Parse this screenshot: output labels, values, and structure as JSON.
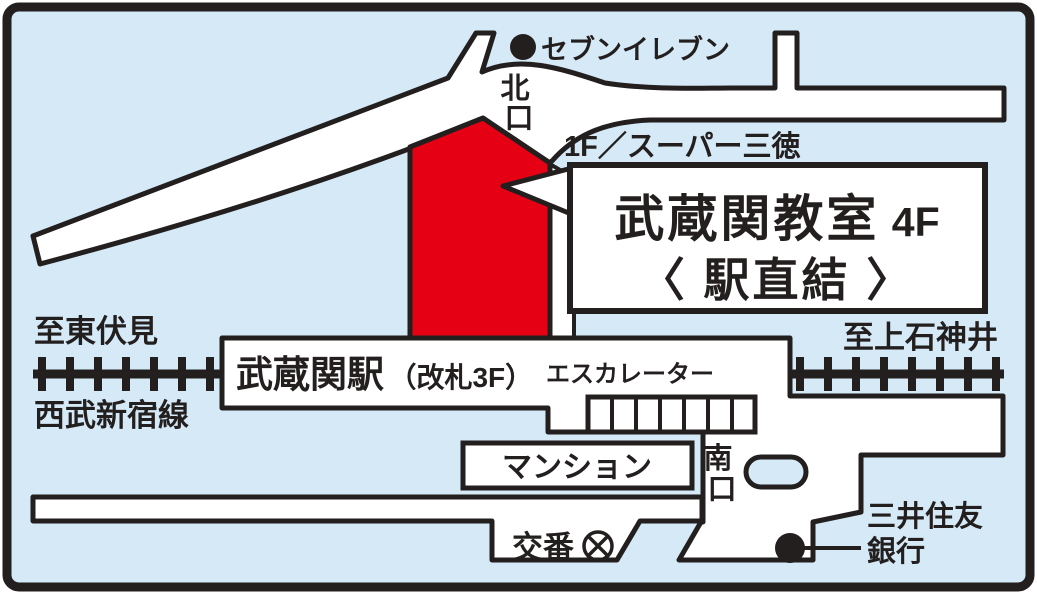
{
  "map": {
    "colors": {
      "background": "#d5e9f7",
      "line_black": "#231f1f",
      "road_white": "#ffffff",
      "building_red": "#e60014",
      "title_blue": "#1766b4"
    },
    "labels": {
      "north_exit_chars": [
        "北",
        "口"
      ],
      "south_exit_chars": [
        "南",
        "口"
      ],
      "seven_eleven": "セブンイレブン",
      "supermarket": "1F／スーパー三徳",
      "to_higashifushimi": "至東伏見",
      "railway_line_name": "西武新宿線",
      "to_kamishakujii": "至上石神井",
      "station_name": "武蔵関駅",
      "station_gate": "（改札3F）",
      "escalator": "エスカレーター",
      "mansion": "マンション",
      "police_box": "交番",
      "bank_line1": "三井住友",
      "bank_line2": "銀行"
    },
    "callout": {
      "classroom_name": "武蔵関教室",
      "floor": "4F",
      "subtitle": "〈 駅直結 〉"
    }
  }
}
